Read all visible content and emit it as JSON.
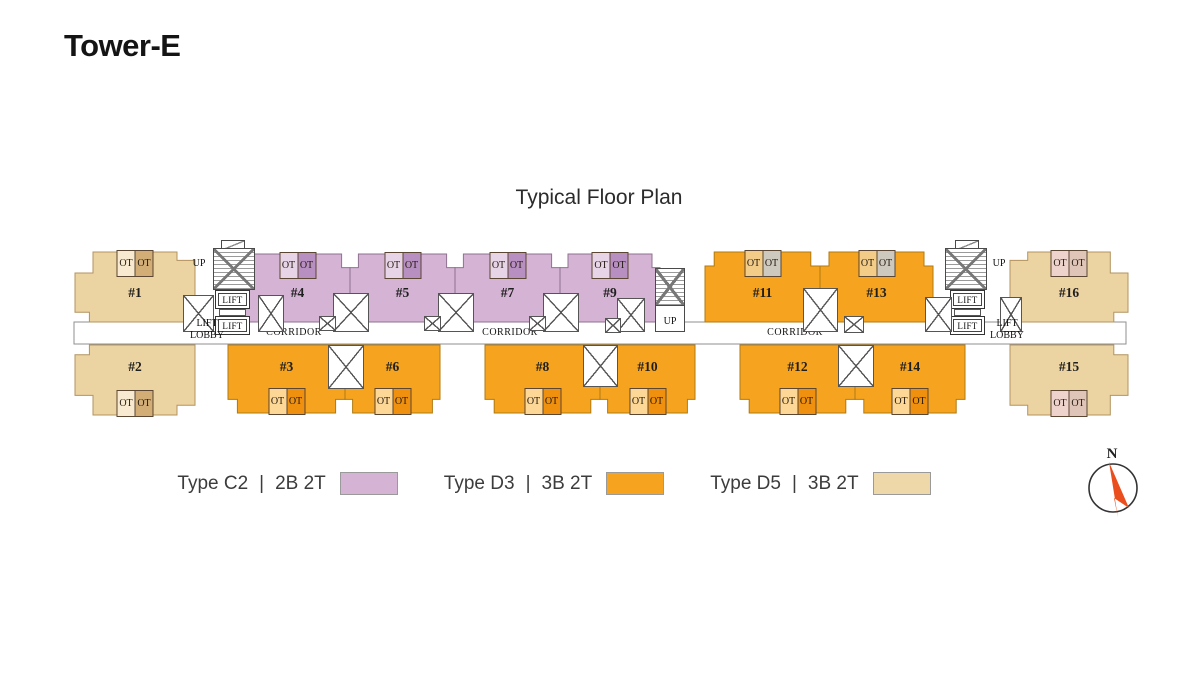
{
  "page": {
    "title": "Tower-E",
    "plan_title": "Typical Floor Plan"
  },
  "plan": {
    "corridor_label": "CORRIDOR",
    "lift_label": "LIFT",
    "lift_lobby_lines": [
      "LIFT",
      "LOBBY"
    ],
    "up_label": "UP",
    "ot_label": "OT"
  },
  "units": [
    {
      "id": "1",
      "label": "#1",
      "type": "D5",
      "row": "top"
    },
    {
      "id": "2",
      "label": "#2",
      "type": "D5",
      "row": "bottom"
    },
    {
      "id": "3",
      "label": "#3",
      "type": "D3",
      "row": "bottom"
    },
    {
      "id": "4",
      "label": "#4",
      "type": "C2",
      "row": "top"
    },
    {
      "id": "5",
      "label": "#5",
      "type": "C2",
      "row": "top"
    },
    {
      "id": "6",
      "label": "#6",
      "type": "D3",
      "row": "bottom"
    },
    {
      "id": "7",
      "label": "#7",
      "type": "C2",
      "row": "top"
    },
    {
      "id": "8",
      "label": "#8",
      "type": "D3",
      "row": "bottom"
    },
    {
      "id": "9",
      "label": "#9",
      "type": "C2",
      "row": "top"
    },
    {
      "id": "10",
      "label": "#10",
      "type": "D3",
      "row": "bottom"
    },
    {
      "id": "11",
      "label": "#11",
      "type": "D3",
      "row": "top",
      "ot_palette": "d3_top_ot"
    },
    {
      "id": "12",
      "label": "#12",
      "type": "D3",
      "row": "bottom"
    },
    {
      "id": "13",
      "label": "#13",
      "type": "D3",
      "row": "top",
      "ot_palette": "d3_top_ot"
    },
    {
      "id": "14",
      "label": "#14",
      "type": "D3",
      "row": "bottom"
    },
    {
      "id": "15",
      "label": "#15",
      "type": "D5",
      "row": "bottom",
      "ot_palette": "d5_right_ot"
    },
    {
      "id": "16",
      "label": "#16",
      "type": "D5",
      "row": "top",
      "ot_palette": "d5_right_ot"
    }
  ],
  "legend": {
    "separator": "|",
    "items": [
      {
        "type_label": "Type C2",
        "spec": "2B 2T",
        "color": "#d5b3d4"
      },
      {
        "type_label": "Type D3",
        "spec": "3B 2T",
        "color": "#f6a41f"
      },
      {
        "type_label": "Type D5",
        "spec": "3B 2T",
        "color": "#eed7a8"
      }
    ]
  },
  "compass": {
    "north_label": "N",
    "arrow_color": "#ea4e1d"
  },
  "colors": {
    "c2_fill": "#d5b3d4",
    "c2_ot": [
      "#e8d4e7",
      "#b78fc1"
    ],
    "d3_fill": "#f6a41f",
    "d3_ot": [
      "#fcd795",
      "#f0900f"
    ],
    "d3_top_ot": [
      "#f3cd87",
      "#cdc9bf"
    ],
    "d5_fill": "#ecd3a2",
    "d5_ot": [
      "#f8ead0",
      "#d2ae76"
    ],
    "d5_right_ot": [
      "#eed3cd",
      "#dfc5b7"
    ]
  }
}
